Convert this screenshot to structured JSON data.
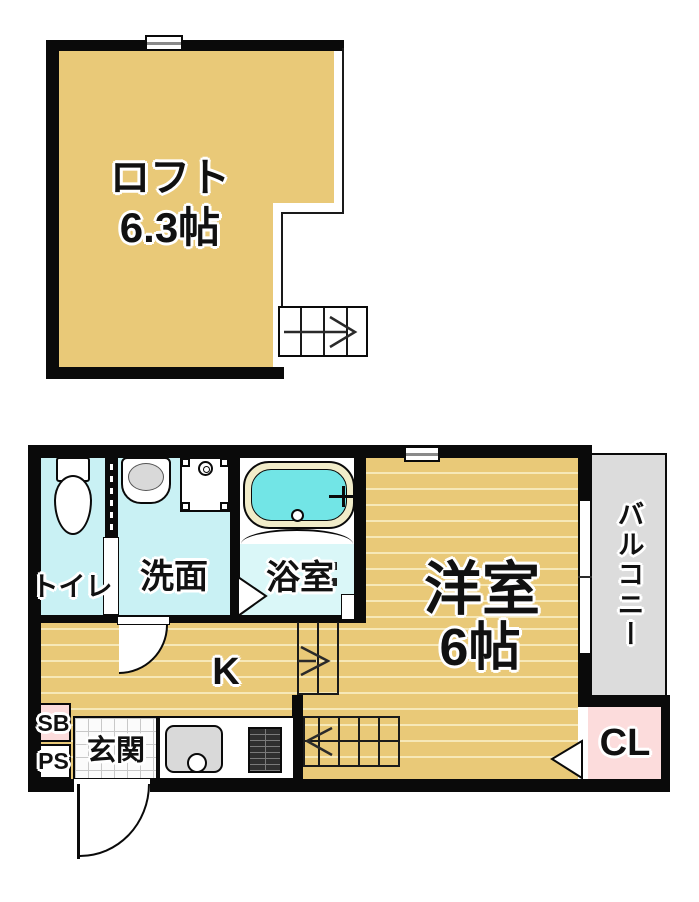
{
  "colors": {
    "wall": "#0a0a0a",
    "loft_floor": "#e9c978",
    "wood_floor": "#e9c978",
    "wood_line": "#f6e8b8",
    "wet_room": "#c9f1f4",
    "bath_floor": "#daf7f8",
    "bath_water": "#72e5e6",
    "tub_rim": "#f1ecc9",
    "balcony": "#dcdcdc",
    "closet_pink": "#fcdcdc",
    "fixture_gray": "#d9d9d9"
  },
  "loft": {
    "label": "ロフト",
    "size": "6.3帖"
  },
  "first_floor": {
    "toilet": "トイレ",
    "washroom": "洗面",
    "bathroom": "浴室",
    "western_room": "洋室",
    "western_room_size": "6帖",
    "kitchen": "K",
    "entrance": "玄関",
    "balcony": "バルコニー",
    "closet": "CL",
    "shoe_box": "SB",
    "pipe_space": "PS"
  }
}
